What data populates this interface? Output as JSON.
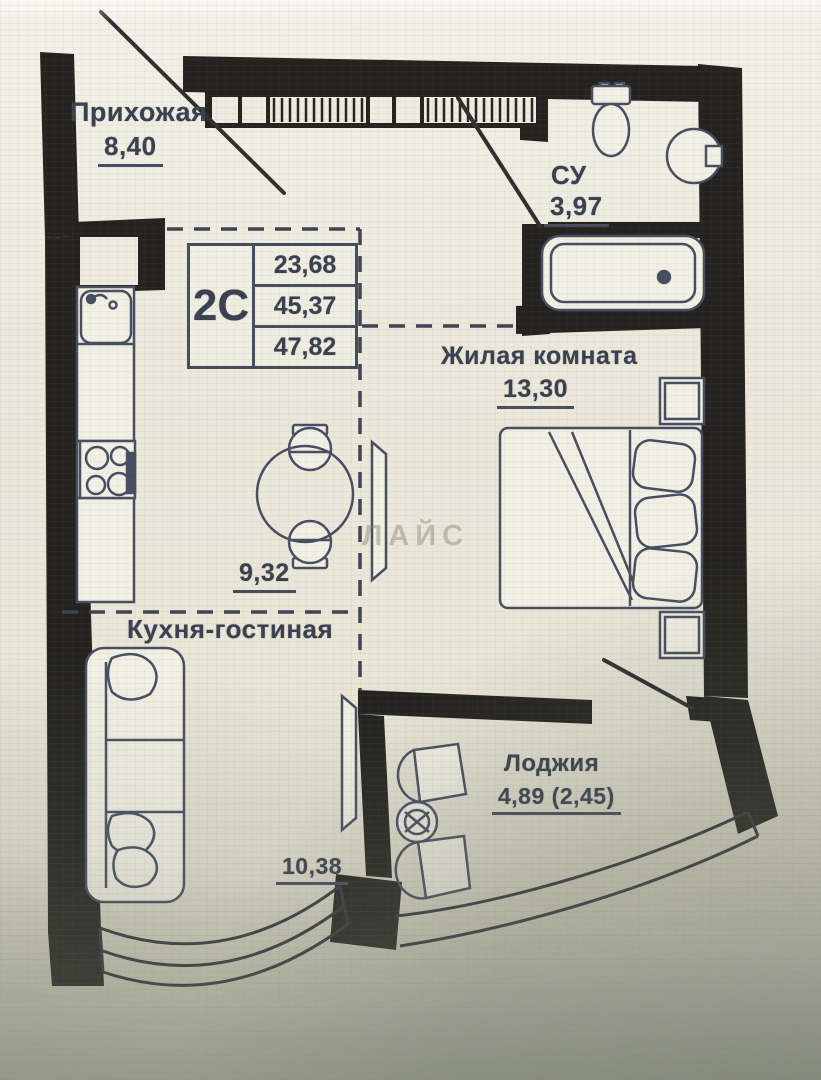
{
  "meta": {
    "width": 821,
    "height": 1080,
    "kind": "apartment floor plan photo"
  },
  "watermark": "ЛАЙС",
  "rooms": {
    "hallway": {
      "name": "Прихожая",
      "area": "8,40"
    },
    "bathroom": {
      "name": "СУ",
      "area": "3,97"
    },
    "living_room": {
      "name": "Жилая комната",
      "area": "13,30"
    },
    "kitchen_living": {
      "name": "Кухня-гостиная",
      "kitchen_zone_area": "9,32",
      "living_zone_area": "10,38"
    },
    "loggia": {
      "name": "Лоджия",
      "area": "4,89 (2,45)"
    }
  },
  "unit_info": {
    "unit_type": "2С",
    "area_rows": [
      "23,68",
      "45,37",
      "47,82"
    ]
  },
  "colors": {
    "paper": "#ece9dc",
    "wall": "#24231f",
    "ink": "#474e62",
    "text": "#39404f",
    "shade": "#b9bcab"
  }
}
